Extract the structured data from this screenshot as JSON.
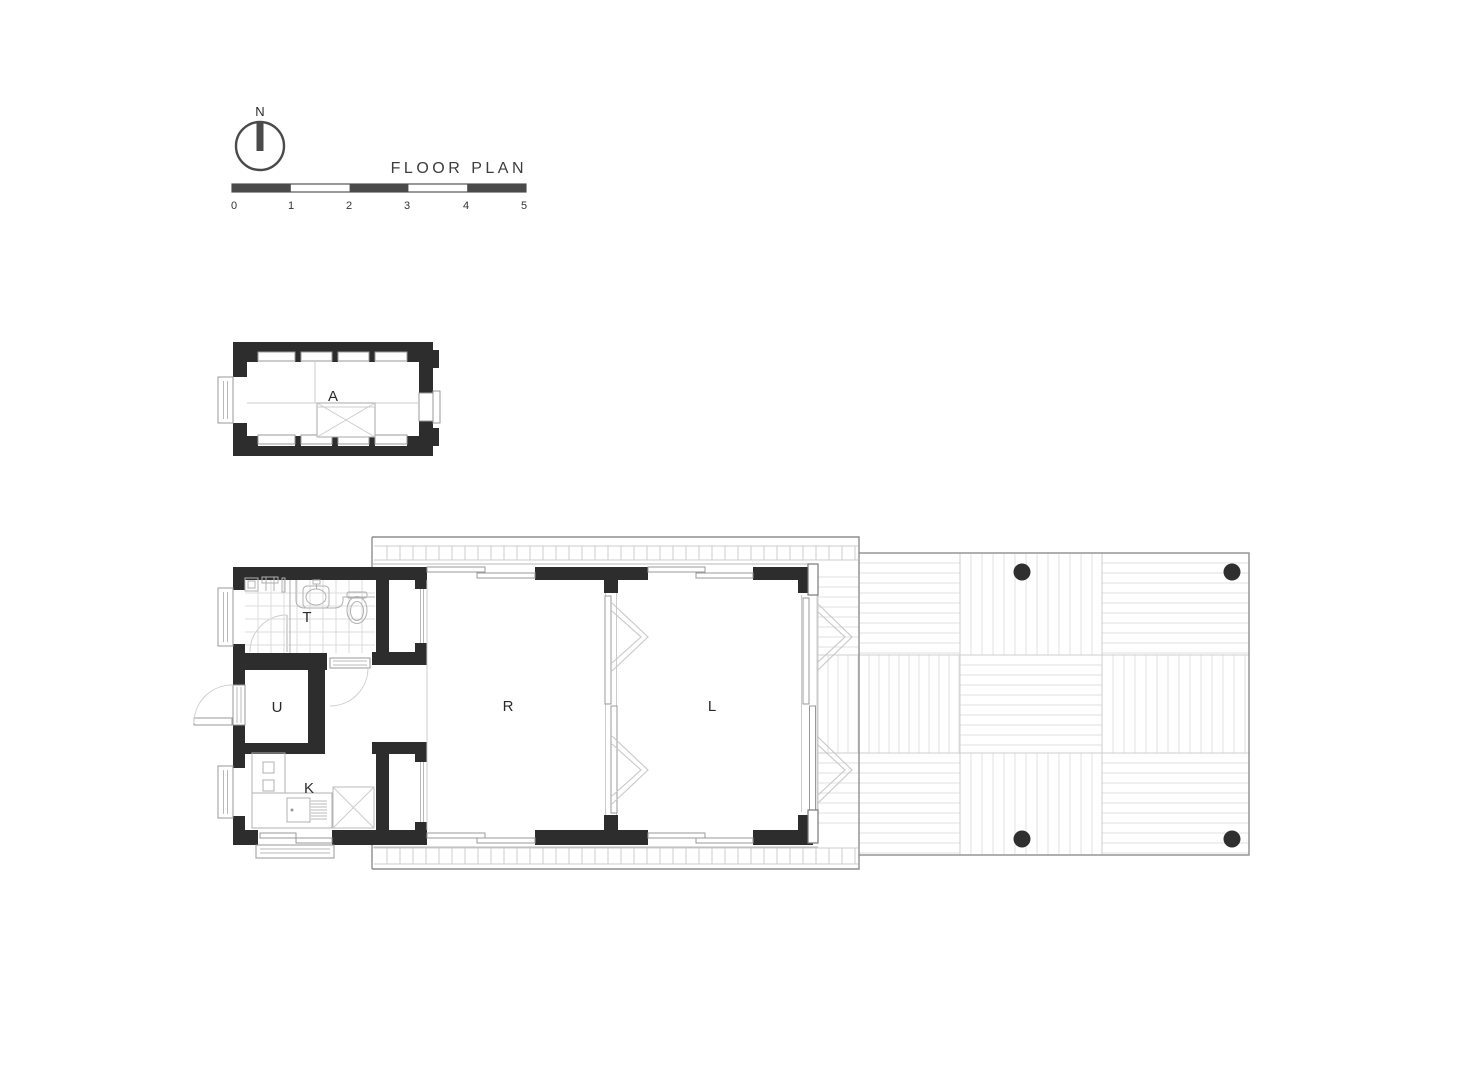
{
  "title": "FLOOR PLAN",
  "compass": {
    "label": "N"
  },
  "scale_bar": {
    "ticks": [
      "0",
      "1",
      "2",
      "3",
      "4",
      "5"
    ]
  },
  "rooms": {
    "attic": "A",
    "bathroom": "T",
    "utility": "U",
    "kitchen": "K",
    "room": "R",
    "living": "L"
  },
  "palette": {
    "wall": "#2d2d2d",
    "outline": "#8f8f8f",
    "plank": "#e0e0e0",
    "fixture": "#b0b0b0",
    "label_text": "#2a2a2a"
  },
  "deck": {
    "column_count": 4
  }
}
